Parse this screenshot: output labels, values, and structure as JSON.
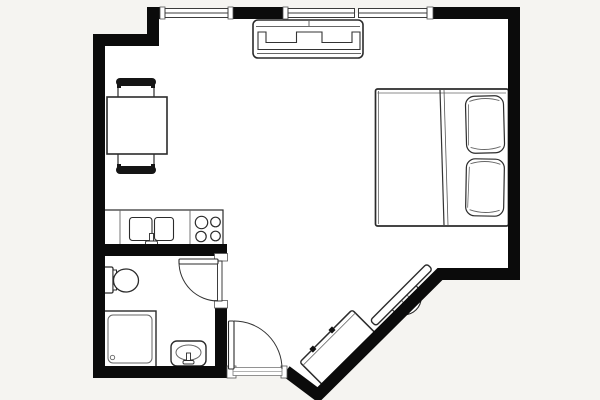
{
  "document": {
    "type": "architectural-floor-plan",
    "description": "studio apartment floor plan, top-down view, no visible text labels"
  },
  "colors": {
    "background": "#f5f4f1",
    "room": "#ffffff",
    "wall": "#0b0b0b",
    "furniture_outline": "#2b2b2b",
    "detail": "#666666",
    "glass_frame": "#3c3c3c"
  },
  "rooms": [
    {
      "name": "main-room",
      "contents": [
        "sofa",
        "dining-table",
        "double-bed",
        "kitchen-counter",
        "tv",
        "cabinet"
      ]
    },
    {
      "name": "bathroom",
      "contents": [
        "toilet",
        "shower",
        "washbasin"
      ]
    },
    {
      "name": "entry-nook",
      "contents": []
    }
  ],
  "furniture": [
    {
      "name": "sofa",
      "location": "top-center, against top wall between windows"
    },
    {
      "name": "dining-table",
      "location": "upper-left, two chairs"
    },
    {
      "name": "dining-chair-top",
      "location": "above dining table"
    },
    {
      "name": "dining-chair-bottom",
      "location": "below dining table"
    },
    {
      "name": "double-bed",
      "location": "right side, headboard on right wall, two pillows"
    },
    {
      "name": "kitchen-counter",
      "location": "left-center, double sink and 4-burner stove"
    },
    {
      "name": "toilet",
      "location": "bathroom upper-left"
    },
    {
      "name": "shower",
      "location": "bathroom lower-left"
    },
    {
      "name": "washbasin",
      "location": "bathroom lower-right"
    },
    {
      "name": "tv",
      "location": "on diagonal wall, lower-right"
    },
    {
      "name": "cabinet",
      "location": "on diagonal wall, lower-right, two knobs"
    }
  ],
  "openings": [
    {
      "name": "window-1",
      "wall": "top",
      "approx_span_px": [
        165,
        228
      ]
    },
    {
      "name": "window-2",
      "wall": "top",
      "approx_span_px": [
        288,
        355
      ]
    },
    {
      "name": "window-3",
      "wall": "top",
      "approx_span_px": [
        358,
        427
      ]
    },
    {
      "name": "bathroom-door",
      "type": "swing-in",
      "wall": "bathroom right wall"
    },
    {
      "name": "entry-door",
      "type": "swing-in",
      "wall": "bottom wall"
    }
  ]
}
